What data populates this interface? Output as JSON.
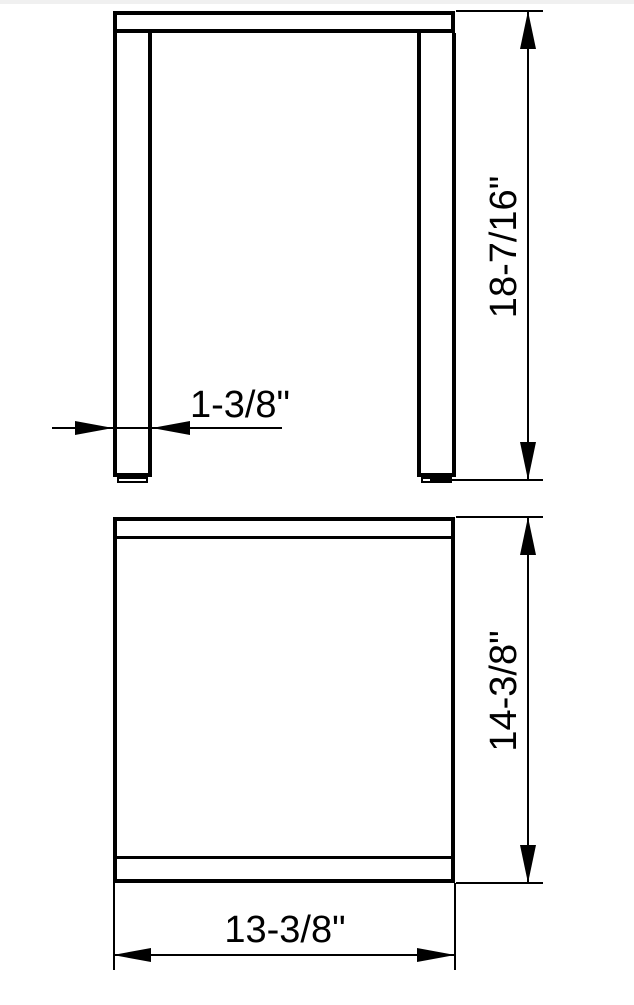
{
  "colors": {
    "line": "#000000",
    "text": "#000000",
    "background": "#ffffff"
  },
  "front_view": {
    "dimensions": {
      "overall_height": {
        "label": "18-7/16\""
      },
      "leg_width": {
        "label": "1-3/8\""
      }
    }
  },
  "top_view": {
    "dimensions": {
      "overall_depth": {
        "label": "14-3/8\""
      },
      "overall_width": {
        "label": "13-3/8\""
      }
    }
  }
}
